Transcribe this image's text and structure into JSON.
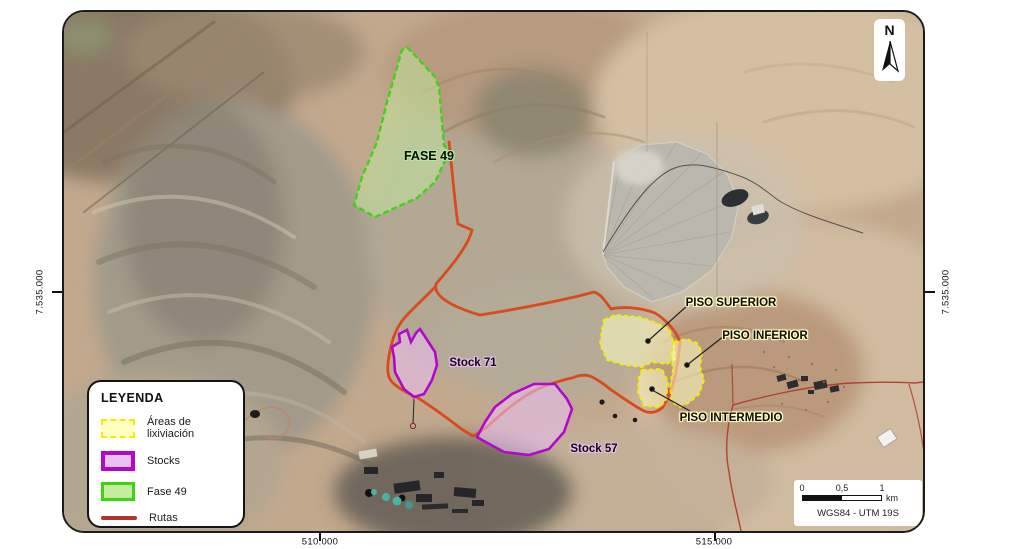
{
  "map": {
    "north_label": "N",
    "labels": {
      "fase49": "FASE 49",
      "stock71": "Stock 71",
      "stock57": "Stock 57",
      "piso_superior": "PISO SUPERIOR",
      "piso_inferior": "PISO INFERIOR",
      "piso_intermedio": "PISO INTERMEDIO"
    },
    "coordinates": {
      "west": "7.535.000",
      "east": "7.535.000",
      "south_west": "510.000",
      "south_east": "515.000"
    }
  },
  "legend": {
    "title": "LEYENDA",
    "items": [
      {
        "id": "leach",
        "label": "Áreas de lixiviación"
      },
      {
        "id": "stocks",
        "label": "Stocks"
      },
      {
        "id": "fase49",
        "label": "Fase 49"
      },
      {
        "id": "rutas",
        "label": "Rutas"
      }
    ]
  },
  "scalebar": {
    "tick_start": "0",
    "tick_mid": "0,5",
    "tick_end": "1",
    "unit": "km",
    "datum": "WGS84 - UTM 19S"
  },
  "colors": {
    "leach_border": "#f1ef00",
    "leach_fill": "#ffffc2",
    "stock_border": "#b108cc",
    "stock_fill": "#e9c0f2",
    "fase_border": "#3ed313",
    "fase_fill": "#c4ec9e",
    "route": "#d94a1e",
    "route_legend": "#b0352b"
  }
}
